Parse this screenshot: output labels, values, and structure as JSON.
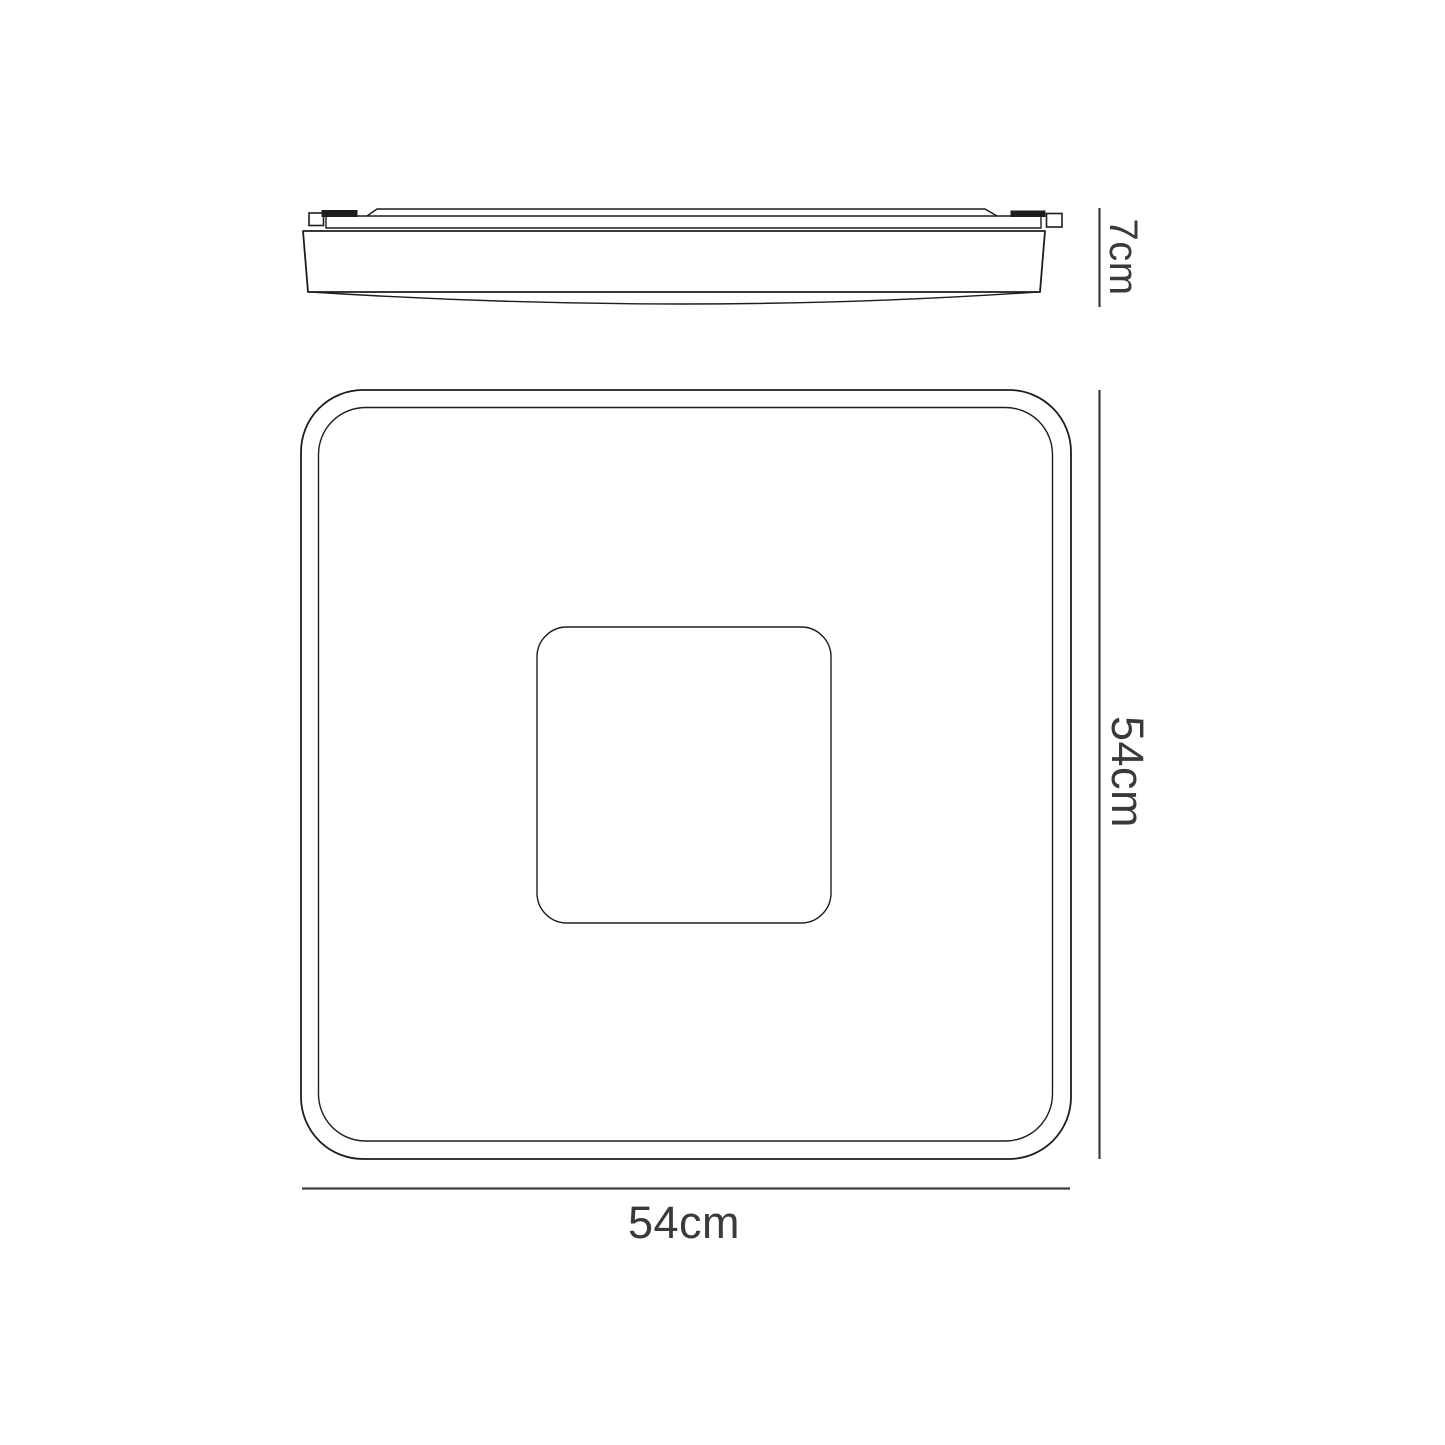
{
  "diagram": {
    "type": "technical-dimension-drawing",
    "subject": "square-flush-ceiling-light",
    "colors": {
      "background": "#ffffff",
      "outline": "#1d1d1b",
      "dimension_line": "#3d3d3d",
      "dimension_text": "#3a3a3a"
    },
    "dimensions": {
      "fixture_depth_label": "7cm",
      "fixture_height_label": "54cm",
      "fixture_width_label": "54cm"
    }
  }
}
